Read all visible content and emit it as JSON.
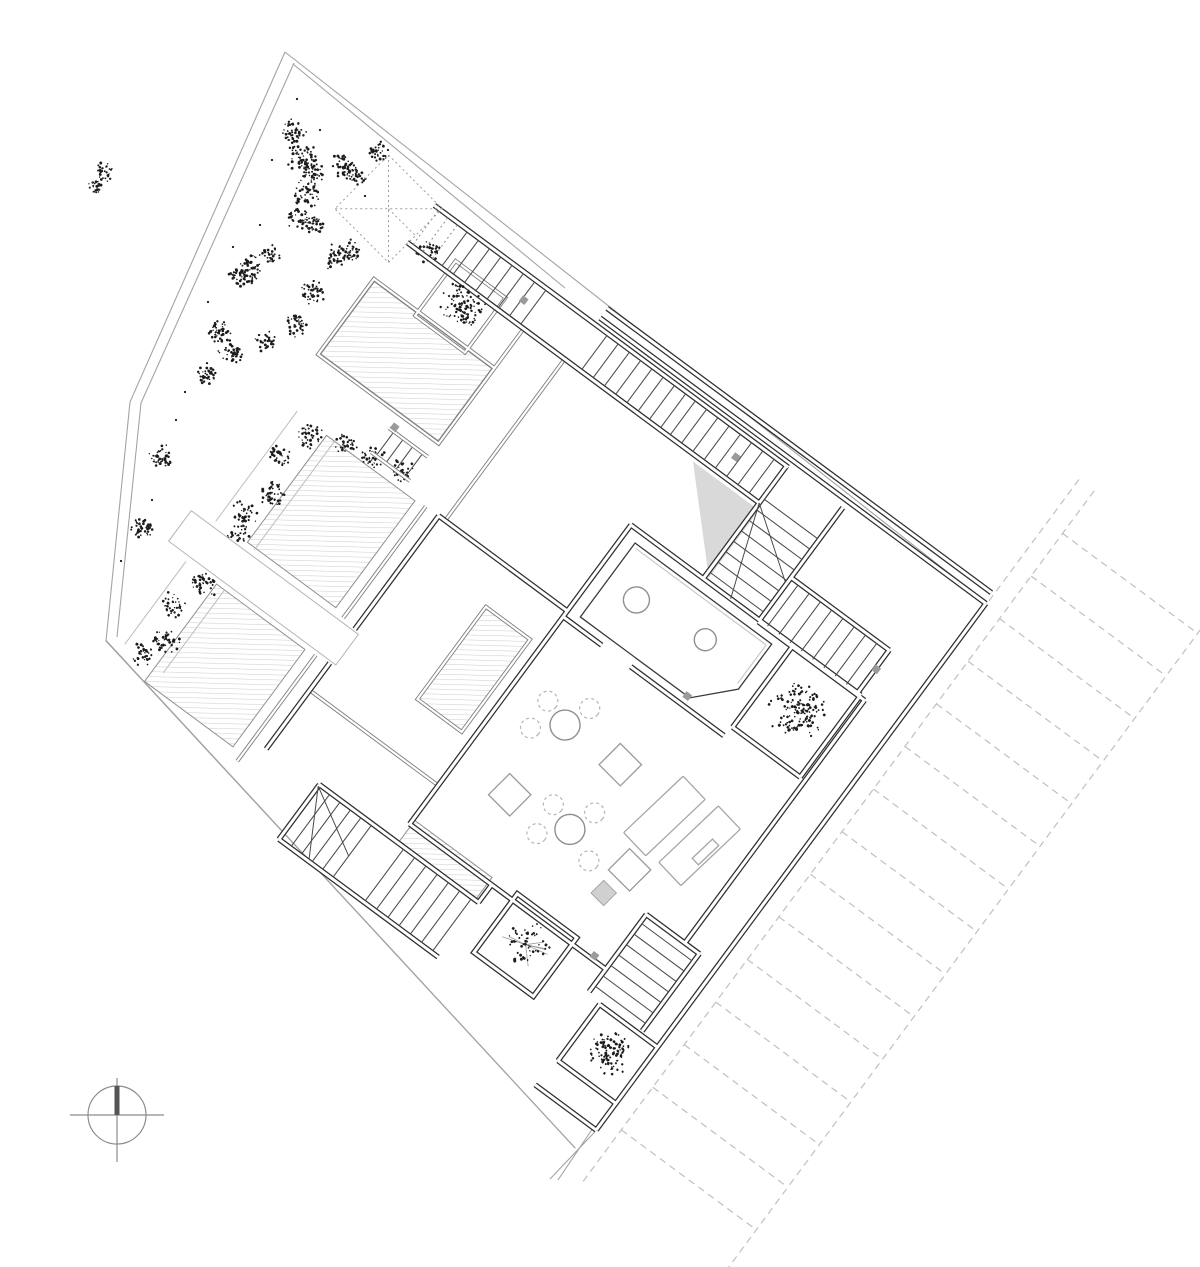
{
  "document": {
    "background": "#ffffff"
  },
  "palette": {
    "walls": "#2e2e2e",
    "partitions": "#7d7d7d",
    "boundary": "#a3a3a3",
    "hatch": "#cfcfcf",
    "vegetation": "#1c1c1c",
    "parking_dash": "#c2c2c2",
    "furniture": "#9a9a9a",
    "shade_fill": "#d9d9d9",
    "compass_needle": "#555555"
  },
  "vegetation": {
    "garden_clusters": [
      [
        293,
        131,
        15,
        48
      ],
      [
        302,
        156,
        17,
        58
      ],
      [
        313,
        174,
        13,
        40
      ],
      [
        342,
        166,
        15,
        48
      ],
      [
        357,
        175,
        11,
        32
      ],
      [
        306,
        194,
        15,
        48
      ],
      [
        299,
        217,
        13,
        42
      ],
      [
        315,
        225,
        11,
        34
      ],
      [
        251,
        269,
        15,
        52
      ],
      [
        238,
        278,
        11,
        32
      ],
      [
        335,
        257,
        13,
        40
      ],
      [
        351,
        251,
        11,
        32
      ],
      [
        312,
        292,
        13,
        42
      ],
      [
        297,
        325,
        12,
        38
      ],
      [
        266,
        341,
        11,
        34
      ],
      [
        219,
        333,
        13,
        42
      ],
      [
        230,
        353,
        13,
        42
      ],
      [
        207,
        375,
        12,
        38
      ],
      [
        161,
        457,
        14,
        46
      ],
      [
        143,
        530,
        13,
        42
      ],
      [
        104,
        171,
        11,
        32
      ],
      [
        95,
        186,
        9,
        26
      ],
      [
        380,
        152,
        11,
        32
      ],
      [
        270,
        255,
        10,
        28
      ]
    ],
    "garden_dots": [
      [
        297,
        99
      ],
      [
        388,
        150
      ],
      [
        272,
        160
      ],
      [
        233,
        247
      ],
      [
        208,
        302
      ],
      [
        176,
        420
      ],
      [
        152,
        500
      ],
      [
        121,
        561
      ],
      [
        260,
        225
      ],
      [
        320,
        130
      ],
      [
        365,
        196
      ],
      [
        185,
        392
      ]
    ],
    "hedge_clusters": [
      [
        -162,
        268,
        15,
        40
      ],
      [
        -176,
        300,
        14,
        36
      ],
      [
        -158,
        336,
        15,
        40
      ],
      [
        -170,
        368,
        14,
        36
      ],
      [
        -162,
        388,
        12,
        30
      ],
      [
        -160,
        452,
        15,
        40
      ],
      [
        -173,
        486,
        14,
        36
      ],
      [
        -157,
        518,
        15,
        40
      ],
      [
        -168,
        542,
        12,
        32
      ],
      [
        -130,
        252,
        13,
        34
      ],
      [
        -100,
        247,
        13,
        34
      ],
      [
        -68,
        241,
        13,
        34
      ],
      [
        -177,
        48,
        13,
        34
      ]
    ],
    "planter_trees": [
      {
        "x": -119,
        "y": 72,
        "r": 24,
        "n": 105,
        "branches": false
      },
      {
        "x": 392,
        "y": 198,
        "r": 30,
        "n": 140,
        "branches": false
      },
      {
        "x": 313,
        "y": 548,
        "r": 24,
        "n": 55,
        "branches": true
      },
      {
        "x": 444,
        "y": 586,
        "r": 24,
        "n": 105,
        "branches": false
      }
    ]
  },
  "parking": {
    "rails": [
      [
        481,
        -155,
        -2
      ],
      [
        500,
        -155,
        705
      ],
      [
        668,
        -155,
        705
      ]
    ],
    "dividers": {
      "x1": 500,
      "x2": 668,
      "y0": -102,
      "step": 53,
      "count": 15
    },
    "stall_count": 14
  },
  "stairs": {
    "flights": [
      {
        "id": "entry-dotted",
        "o": "v",
        "x0": -194,
        "step": 12,
        "n": 3,
        "y1": 10,
        "y2": 52,
        "dotted": true
      },
      {
        "id": "entry",
        "o": "v",
        "x0": -158,
        "step": 14,
        "n": 8,
        "y1": 10,
        "y2": 52,
        "dotted": false
      },
      {
        "id": "upper-corridor-a",
        "o": "v",
        "x0": 16,
        "step": 14,
        "n": 8,
        "y1": 10,
        "y2": 52,
        "dotted": false
      },
      {
        "id": "upper-corridor-b",
        "o": "v",
        "x0": 126,
        "step": 14,
        "n": 8,
        "y1": 10,
        "y2": 52,
        "dotted": false
      },
      {
        "id": "core",
        "o": "h",
        "y0": 48,
        "step": 13,
        "n": 8,
        "x1": 240,
        "x2": 306,
        "dotted": false
      },
      {
        "id": "right-room",
        "o": "v",
        "x0": 318,
        "step": 14,
        "n": 8,
        "y1": 97,
        "y2": 148,
        "dotted": false
      },
      {
        "id": "south",
        "o": "h",
        "y0": 462,
        "step": 13,
        "n": 7,
        "x1": 394,
        "x2": 456,
        "dotted": false
      },
      {
        "id": "winder",
        "o": "v",
        "x0": 66,
        "step": 13,
        "n": 5,
        "y1": 544,
        "y2": 608,
        "dotted": false
      },
      {
        "id": "west-flight",
        "o": "v",
        "x0": 158,
        "step": 14,
        "n": 7,
        "y1": 544,
        "y2": 608,
        "dotted": false
      },
      {
        "id": "garden-steps",
        "o": "v",
        "x0": -98,
        "step": 12,
        "n": 4,
        "y1": 216,
        "y2": 242,
        "dotted": false
      }
    ]
  },
  "furniture": {
    "tables": [
      [
        214,
        348
      ],
      [
        280,
        429
      ]
    ],
    "table_r": 15,
    "chairs": [
      [
        186,
        339
      ],
      [
        224,
        320
      ],
      [
        188,
        371
      ],
      [
        252,
        419
      ],
      [
        290,
        401
      ],
      [
        256,
        452
      ],
      [
        314,
        443
      ]
    ],
    "chair_r": 10,
    "stools": [
      [
        211,
        437
      ],
      [
        282,
        347
      ],
      [
        352,
        426
      ]
    ],
    "stool_size": 30,
    "stool_rot": 8.5,
    "side_table": [
      345,
      460
    ],
    "side_size": 18,
    "loungers": [
      [
        348,
        362
      ],
      [
        394,
        365
      ]
    ],
    "lounger_w": 32,
    "lounger_h": 82,
    "lounger_rot": 10,
    "sink_circles": [
      [
        197,
        205,
        13
      ],
      [
        276,
        196,
        11
      ]
    ]
  },
  "doors": {
    "size": 7,
    "positions": [
      [
        -72,
        31
      ],
      [
        192,
        31
      ],
      [
        431,
        118
      ],
      [
        375,
        516
      ],
      [
        -100,
        210
      ],
      [
        295,
        252
      ]
    ]
  },
  "compass": {
    "cx": 117,
    "cy": 1115,
    "r": 29
  }
}
